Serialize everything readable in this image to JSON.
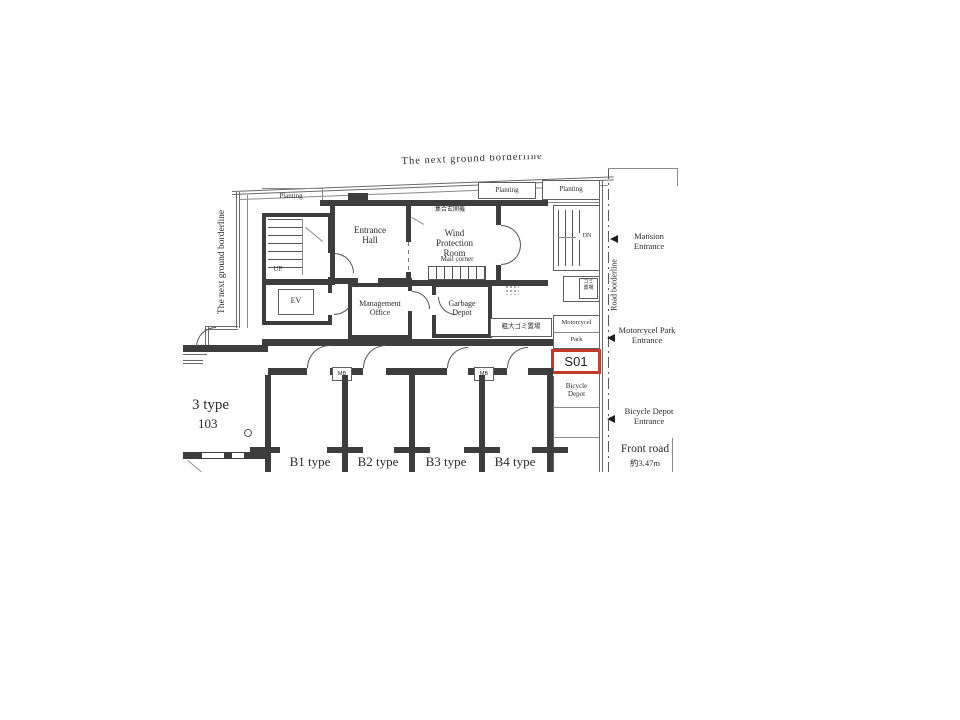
{
  "plan": {
    "borderline_top": "The next ground borderline",
    "borderline_left": "The next ground borderline",
    "road_borderline": "Road borderline",
    "planting_left": "Planting",
    "planting_mid": "Planting",
    "planting_right": "Planting",
    "entrance_hall": "Entrance\nHall",
    "wind_protection_room": "Wind\nProtection\nRoom",
    "intercom_note": "集合玄関機",
    "mail_corner": "Mail corner",
    "management_office": "Management\nOffice",
    "garbage_depot": "Garbage\nDepot",
    "bulky_garbage": "粗大ゴミ置場",
    "garbage_store_small": "ゴミ\n置場",
    "up": "UP",
    "dn": "DN",
    "ev": "EV",
    "mb1": "MB",
    "mb2": "MB",
    "motorcycle_park_line1": "Motorcycel",
    "motorcycle_park_line2": "Park",
    "bicycle_depot": "Bicycle\nDepot",
    "highlight": {
      "label": "S01",
      "color": "#c0392b"
    },
    "left_unit": {
      "type": "3 type",
      "number": "103"
    },
    "units": [
      "B1 type",
      "B2 type",
      "B3 type",
      "B4 type"
    ],
    "annotations": {
      "mansion_entrance": "Mansion\nEntrance",
      "motorcycle_park_entrance": "Motorcycel Park\nEntrance",
      "bicycle_depot_entrance": "Bicycle Depot\nEntrance",
      "front_road": "Front road",
      "front_road_width": "約3.47m"
    }
  }
}
